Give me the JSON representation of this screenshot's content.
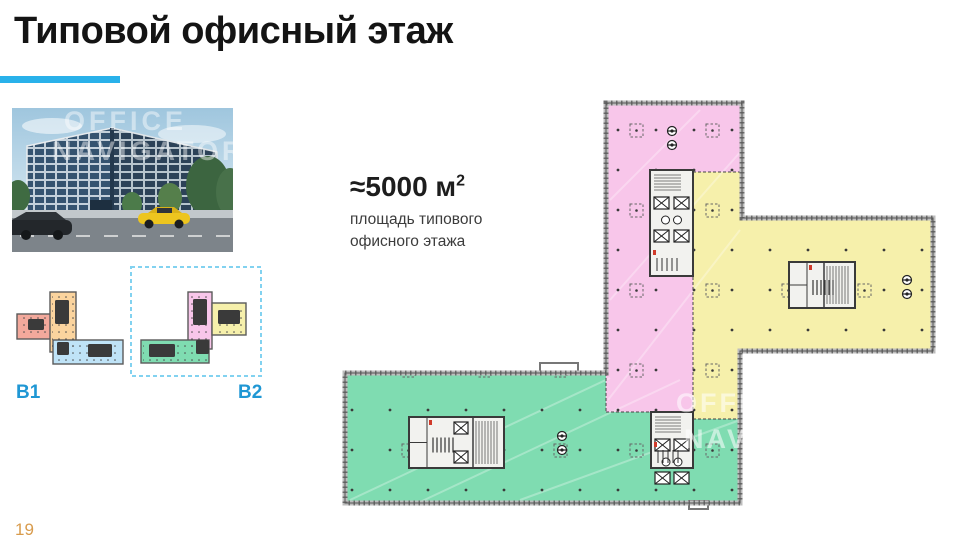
{
  "slide": {
    "title": "Типовой офисный этаж",
    "page_number": "19"
  },
  "area": {
    "value": "≈5000 м",
    "sup": "2",
    "caption_line1": "площадь типового",
    "caption_line2": "офисного этажа"
  },
  "watermark": {
    "line1": "OFFICE",
    "line2": "NAVIGATOR"
  },
  "labels": {
    "b1": "B1",
    "b2": "B2"
  },
  "colors": {
    "accent": "#29b1ea",
    "label_blue": "#1f97d4",
    "page_orange": "#d89b4c",
    "pink": "#f8c6ea",
    "yellow": "#f6f0ab",
    "green": "#7fdcb1",
    "salmon": "#f3a99c",
    "orange": "#fbd49e",
    "blue": "#bfe3f7",
    "wall_gray": "#8f8f8f",
    "core_dark": "#3a3a3a",
    "dashed_box_cyan": "#82d2f0"
  },
  "floor_plan": {
    "outline": "M606,103 H742 V218 H933 V351 H740 V503 H345 V373 H606 Z",
    "regions": [
      {
        "name": "pink",
        "color": "pink",
        "path": "M606,103 H742 V172 H693 V412 H606 Z"
      },
      {
        "name": "yellow",
        "color": "yellow",
        "path": "M693,172 H742 V218 H933 V351 H740 V419 H693 Z"
      },
      {
        "name": "green",
        "color": "green",
        "path": "M345,373 H606 V412 H693 V419 H740 V503 H345 Z"
      }
    ],
    "boundaries": [
      "M693,172 H742",
      "M693,172 V419",
      "M606,373 V412",
      "M606,412 H693",
      "M693,419 H740"
    ],
    "bumps": [
      {
        "x": 540,
        "y": 363,
        "w": 38,
        "h": 10
      },
      {
        "x": 689,
        "y": 501,
        "w": 19,
        "h": 8
      }
    ],
    "cores": [
      {
        "name": "pink-core",
        "x": 650,
        "y": 170,
        "w": 43,
        "h": 106,
        "dir": "v"
      },
      {
        "name": "yellow-core",
        "x": 789,
        "y": 262,
        "w": 66,
        "h": 46,
        "dir": "h"
      },
      {
        "name": "green-core",
        "x": 409,
        "y": 417,
        "w": 95,
        "h": 51,
        "dir": "h",
        "elev": true
      },
      {
        "name": "junction-core",
        "x": 651,
        "y": 412,
        "w": 42,
        "h": 56,
        "dir": "v"
      }
    ],
    "circles": [
      [
        672,
        131
      ],
      [
        672,
        145
      ],
      [
        907,
        280
      ],
      [
        907,
        294
      ],
      [
        562,
        436
      ],
      [
        562,
        450
      ]
    ],
    "streaks": [
      [
        350,
        500,
        610,
        378
      ],
      [
        420,
        502,
        680,
        380
      ],
      [
        520,
        500,
        740,
        420
      ],
      [
        608,
        400,
        740,
        230
      ],
      [
        610,
        300,
        742,
        150
      ],
      [
        610,
        200,
        700,
        110
      ]
    ],
    "watermark_pos": [
      [
        676,
        412
      ],
      [
        684,
        448
      ]
    ]
  },
  "mini_plans": {
    "b1": {
      "blocks": [
        {
          "color": "salmon",
          "x": 17,
          "y": 314,
          "w": 36,
          "h": 25
        },
        {
          "color": "orange",
          "x": 50,
          "y": 292,
          "w": 26,
          "h": 60
        },
        {
          "color": "blue",
          "x": 53,
          "y": 340,
          "w": 70,
          "h": 24
        }
      ],
      "cores": [
        {
          "x": 28,
          "y": 319,
          "w": 16,
          "h": 11
        },
        {
          "x": 55,
          "y": 300,
          "w": 14,
          "h": 24
        },
        {
          "x": 88,
          "y": 344,
          "w": 24,
          "h": 13
        },
        {
          "x": 57,
          "y": 342,
          "w": 12,
          "h": 13
        }
      ]
    },
    "b2": {
      "box": {
        "x": 131,
        "y": 267,
        "w": 130,
        "h": 109
      },
      "blocks": [
        {
          "color": "pink",
          "x": 188,
          "y": 292,
          "w": 24,
          "h": 57
        },
        {
          "color": "yellow",
          "x": 212,
          "y": 303,
          "w": 34,
          "h": 32
        },
        {
          "color": "green",
          "x": 141,
          "y": 340,
          "w": 68,
          "h": 23
        }
      ],
      "cores": [
        {
          "x": 193,
          "y": 299,
          "w": 14,
          "h": 26
        },
        {
          "x": 218,
          "y": 310,
          "w": 22,
          "h": 14
        },
        {
          "x": 149,
          "y": 344,
          "w": 26,
          "h": 13
        },
        {
          "x": 196,
          "y": 340,
          "w": 13,
          "h": 14
        }
      ]
    }
  }
}
